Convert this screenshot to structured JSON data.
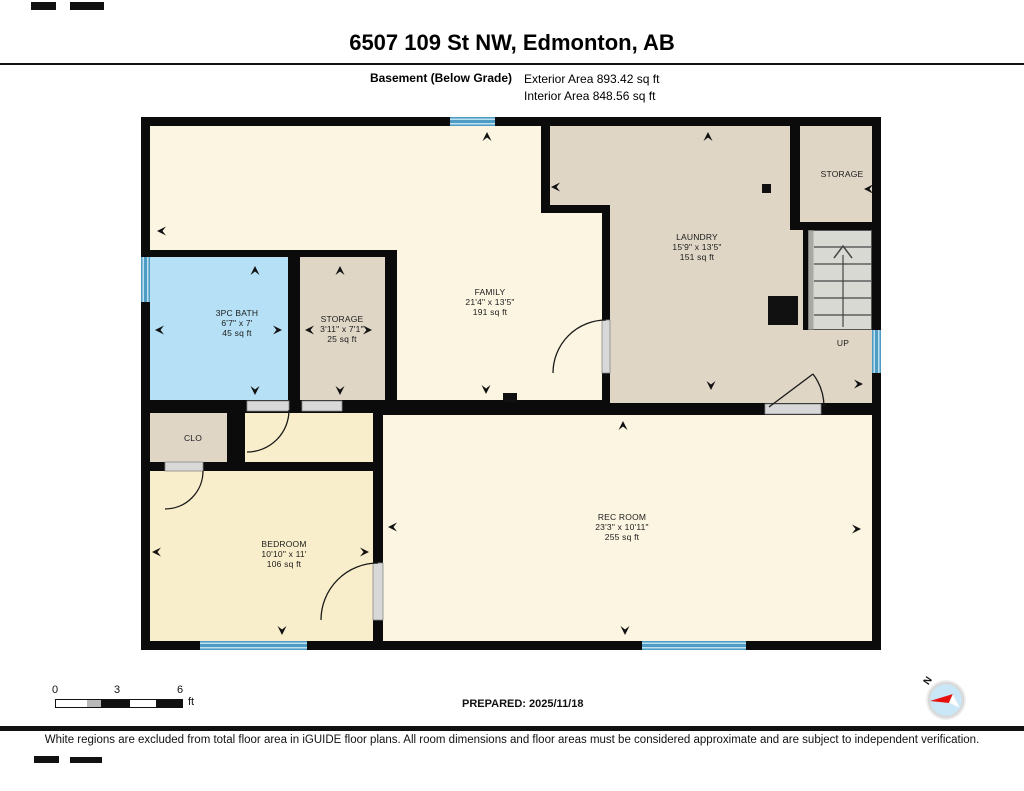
{
  "header": {
    "title": "6507 109 St NW, Edmonton, AB",
    "floor_label": "Basement (Below Grade)",
    "exterior_area": "Exterior Area 893.42 sq ft",
    "interior_area": "Interior Area 848.56 sq ft"
  },
  "rooms": [
    {
      "name": "3PC BATH",
      "dims": "6'7\" x 7'",
      "area": "45 sq ft"
    },
    {
      "name": "STORAGE",
      "dims": "3'11\" x 7'1\"",
      "area": "25 sq ft"
    },
    {
      "name": "FAMILY",
      "dims": "21'4\" x 13'5\"",
      "area": "191 sq ft"
    },
    {
      "name": "LAUNDRY",
      "dims": "15'9\" x 13'5\"",
      "area": "151 sq ft"
    },
    {
      "name": "STORAGE",
      "dims": "",
      "area": ""
    },
    {
      "name": "CLO",
      "dims": "",
      "area": ""
    },
    {
      "name": "BEDROOM",
      "dims": "10'10\" x 11'",
      "area": "106 sq ft"
    },
    {
      "name": "REC ROOM",
      "dims": "23'3\" x 10'11\"",
      "area": "255 sq ft"
    }
  ],
  "stairs": {
    "label": "UP"
  },
  "scale": {
    "tick0": "0",
    "tick3": "3",
    "tick6": "6",
    "unit": "ft"
  },
  "compass": {
    "north_label": "N"
  },
  "footer": {
    "prepared": "PREPARED: 2025/11/18",
    "disclaimer": "White regions are excluded from total floor area in iGUIDE floor plans. All room dimensions and floor areas must be considered approximate and are subject to independent verification."
  },
  "colors": {
    "wall": "#0b0b0b",
    "interior_cream": "#FBF5E1",
    "bedroom_cream": "#F9EECB",
    "utility_beige": "#DFD6C6",
    "bath_blue": "#B5E0F5",
    "window_blue": "#4E9BC4",
    "stairs_gray": "#D9D9D4",
    "door_gray": "#D8D8D8",
    "compass_red": "#E8100C",
    "compass_blue": "#C9E7F6"
  }
}
